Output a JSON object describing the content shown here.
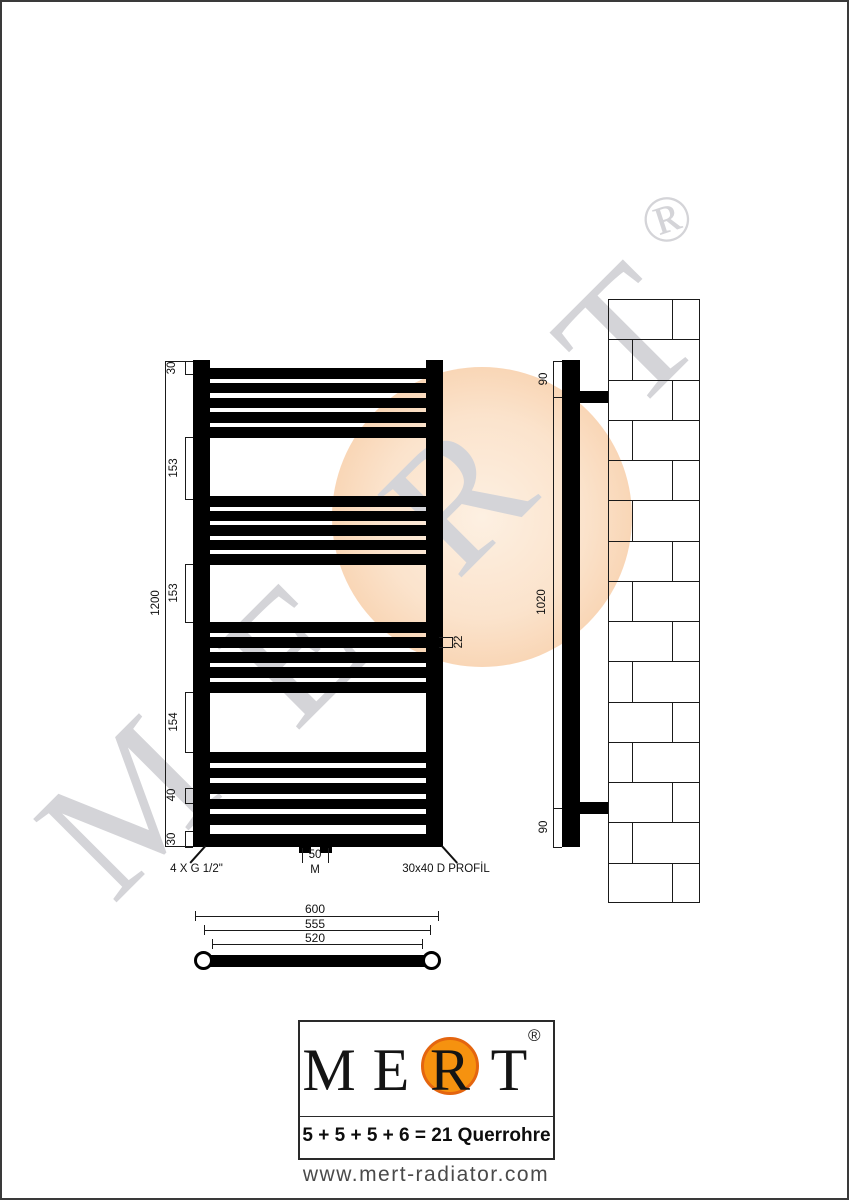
{
  "page": {
    "background": "#ffffff",
    "border_color": "#3a3a3a"
  },
  "watermark": {
    "letters": [
      "M",
      "E",
      "R",
      "T"
    ],
    "registered": "®",
    "letter_color": "#d4d4d8",
    "circle_color": "#f7c9a0"
  },
  "front_view": {
    "height_label": "1200",
    "segment_labels": {
      "top": "30",
      "gap1": "153",
      "gap2": "153",
      "gap3": "154",
      "pitch": "40",
      "bottom": "30"
    },
    "tube_height_label": "22",
    "center_distance_label": "50",
    "center_symbol": "M",
    "connection_note": "4 X G 1/2\"",
    "profile_note": "30x40 D PROFİL",
    "tube_groups": [
      5,
      5,
      5,
      6
    ]
  },
  "side_view": {
    "top_bracket": "90",
    "middle": "1020",
    "bottom_bracket": "90"
  },
  "top_view": {
    "outer": "600",
    "middle": "555",
    "inner": "520"
  },
  "logo": {
    "letters": [
      "M",
      "E",
      "R",
      "T"
    ],
    "registered": "®",
    "formula": "5 + 5 + 5 + 6 = 21 Querrohre",
    "website": "www.mert-radiator.com",
    "orange": "#f6920f",
    "orange_rim": "#e4650f"
  }
}
